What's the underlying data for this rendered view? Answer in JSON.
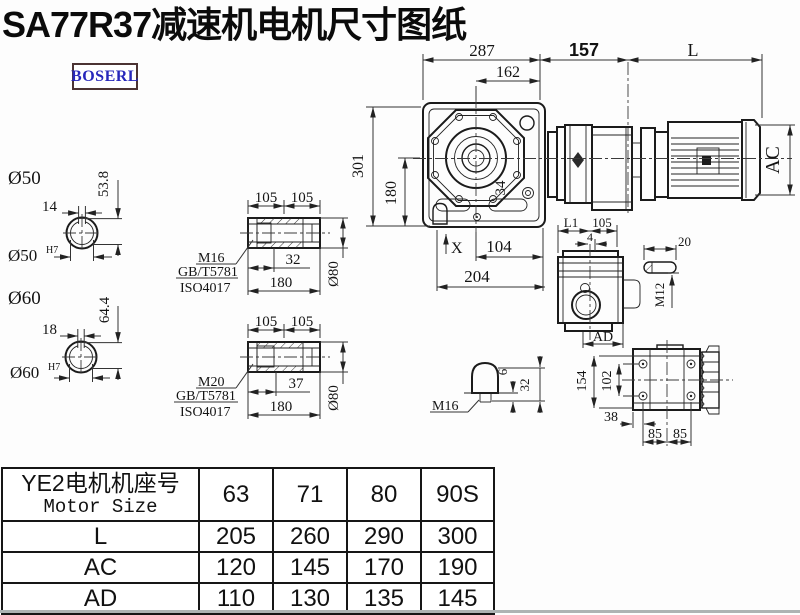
{
  "title": "SA77R37减速机电机尺寸图纸",
  "logo": {
    "text": "BOSERL",
    "text_color": "#2727bb",
    "border_color": "#4b3333"
  },
  "main_view": {
    "dim_287": "287",
    "dim_162": "162",
    "dim_157": "157",
    "dim_l": "L",
    "dim_301": "301",
    "dim_180": "180",
    "dim_34": "34",
    "dim_x": "X",
    "dim_104": "104",
    "dim_204": "204",
    "dim_ac": "AC"
  },
  "shaft_50": {
    "label": "Ø50",
    "dim_width": "14",
    "dim_height": "53.8",
    "bore_label": "Ø50",
    "bore_tolerance": "H7"
  },
  "shaft_60": {
    "label": "Ø60",
    "dim_width": "18",
    "dim_height": "64.4",
    "bore_label": "Ø60",
    "bore_tolerance": "H7"
  },
  "hollow_shaft_1": {
    "dim_105_left": "105",
    "dim_105_right": "105",
    "thread": "M16",
    "standard_1": "GB/T5781",
    "standard_2": "ISO4017",
    "dim_depth": "32",
    "dim_length": "180",
    "dim_diameter": "Ø80"
  },
  "hollow_shaft_2": {
    "dim_105_left": "105",
    "dim_105_right": "105",
    "thread": "M20",
    "standard_1": "GB/T5781",
    "standard_2": "ISO4017",
    "dim_depth": "37",
    "dim_length": "180",
    "dim_diameter": "Ø80"
  },
  "side_view": {
    "dim_l1": "L1",
    "dim_105": "105",
    "dim_4": "4",
    "dim_ad": "AD"
  },
  "key_detail": {
    "dim_20": "20",
    "thread": "M12"
  },
  "breather": {
    "dim_6": "6",
    "dim_32": "32",
    "thread": "M16"
  },
  "rear_view": {
    "dim_154": "154",
    "dim_102": "102",
    "dim_38": "38",
    "dim_85_left": "85",
    "dim_85_right": "85"
  },
  "table": {
    "header_cn": "YE2电机机座号",
    "header_en": "Motor Size",
    "columns": [
      "63",
      "71",
      "80",
      "90S"
    ],
    "rows": [
      {
        "label": "L",
        "values": [
          "205",
          "260",
          "290",
          "300"
        ]
      },
      {
        "label": "AC",
        "values": [
          "120",
          "145",
          "170",
          "190"
        ]
      },
      {
        "label": "AD",
        "values": [
          "110",
          "130",
          "135",
          "145"
        ]
      }
    ]
  }
}
